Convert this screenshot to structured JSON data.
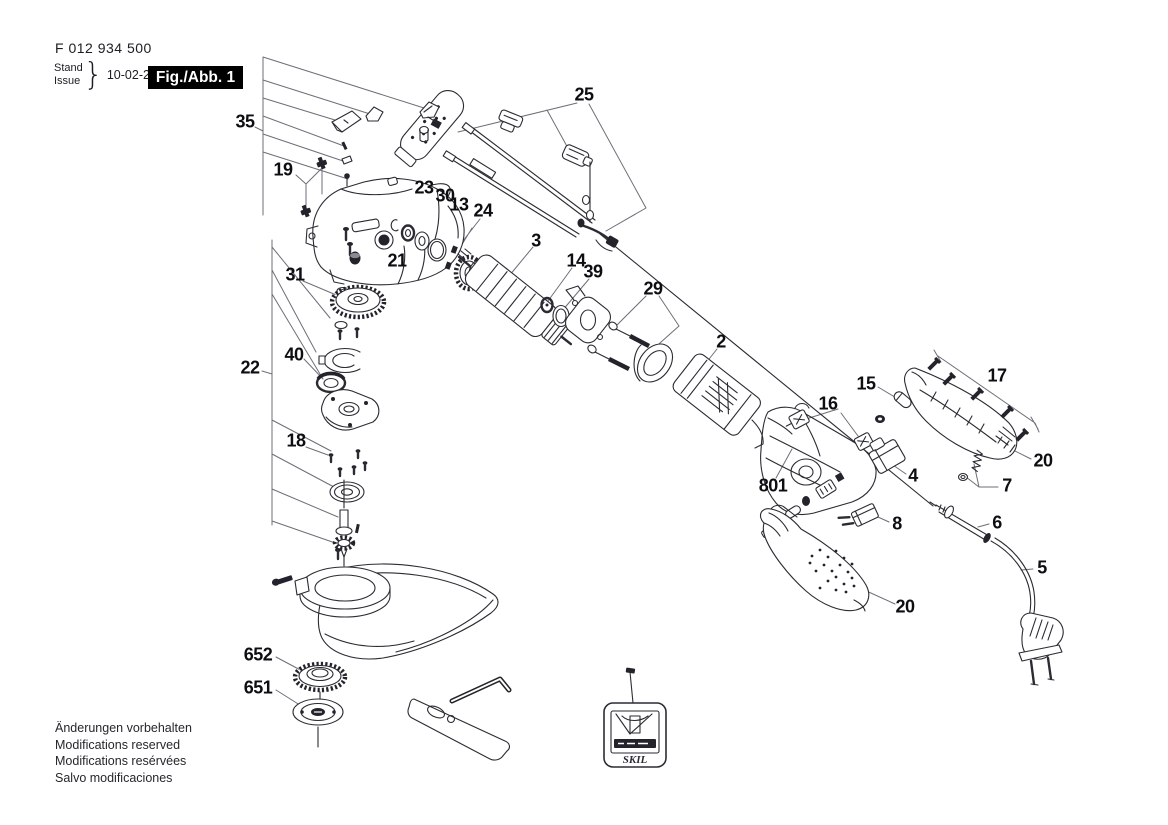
{
  "header": {
    "part_number": "F 012 934 500",
    "stand_label": "Stand",
    "issue_label": "Issue",
    "brace": "}",
    "issue_date": "10-02-24",
    "figure_label": "Fig./Abb. 1"
  },
  "figure": {
    "description": "Exploded parts diagram of an angle grinder",
    "brand_on_tag": "SKIL",
    "callouts": [
      {
        "id": "35",
        "label": "35",
        "x": 245,
        "y": 122
      },
      {
        "id": "19",
        "label": "19",
        "x": 283,
        "y": 170
      },
      {
        "id": "23",
        "label": "23",
        "x": 424,
        "y": 188
      },
      {
        "id": "30",
        "label": "30",
        "x": 445,
        "y": 196
      },
      {
        "id": "13",
        "label": "13",
        "x": 459,
        "y": 205
      },
      {
        "id": "24",
        "label": "24",
        "x": 483,
        "y": 211
      },
      {
        "id": "25",
        "label": "25",
        "x": 584,
        "y": 95
      },
      {
        "id": "21",
        "label": "21",
        "x": 397,
        "y": 261
      },
      {
        "id": "31",
        "label": "31",
        "x": 295,
        "y": 275
      },
      {
        "id": "3",
        "label": "3",
        "x": 536,
        "y": 241
      },
      {
        "id": "14",
        "label": "14",
        "x": 576,
        "y": 261
      },
      {
        "id": "39",
        "label": "39",
        "x": 593,
        "y": 272
      },
      {
        "id": "29",
        "label": "29",
        "x": 653,
        "y": 289
      },
      {
        "id": "2",
        "label": "2",
        "x": 721,
        "y": 342
      },
      {
        "id": "40",
        "label": "40",
        "x": 294,
        "y": 355
      },
      {
        "id": "22",
        "label": "22",
        "x": 250,
        "y": 368
      },
      {
        "id": "18",
        "label": "18",
        "x": 296,
        "y": 441
      },
      {
        "id": "15",
        "label": "15",
        "x": 866,
        "y": 384
      },
      {
        "id": "16",
        "label": "16",
        "x": 828,
        "y": 404
      },
      {
        "id": "17",
        "label": "17",
        "x": 997,
        "y": 376
      },
      {
        "id": "801",
        "label": "801",
        "x": 773,
        "y": 486
      },
      {
        "id": "4",
        "label": "4",
        "x": 913,
        "y": 476
      },
      {
        "id": "20-top",
        "label": "20",
        "x": 1043,
        "y": 461
      },
      {
        "id": "7",
        "label": "7",
        "x": 1007,
        "y": 486
      },
      {
        "id": "8",
        "label": "8",
        "x": 897,
        "y": 524
      },
      {
        "id": "6",
        "label": "6",
        "x": 997,
        "y": 523
      },
      {
        "id": "5",
        "label": "5",
        "x": 1042,
        "y": 568
      },
      {
        "id": "20-bottom",
        "label": "20",
        "x": 905,
        "y": 607
      },
      {
        "id": "652",
        "label": "652",
        "x": 258,
        "y": 655
      },
      {
        "id": "651",
        "label": "651",
        "x": 258,
        "y": 688
      }
    ]
  },
  "footer": {
    "lines": [
      "Änderungen vorbehalten",
      "Modifications reserved",
      "Modifications resérvées",
      "Salvo modificaciones"
    ]
  }
}
